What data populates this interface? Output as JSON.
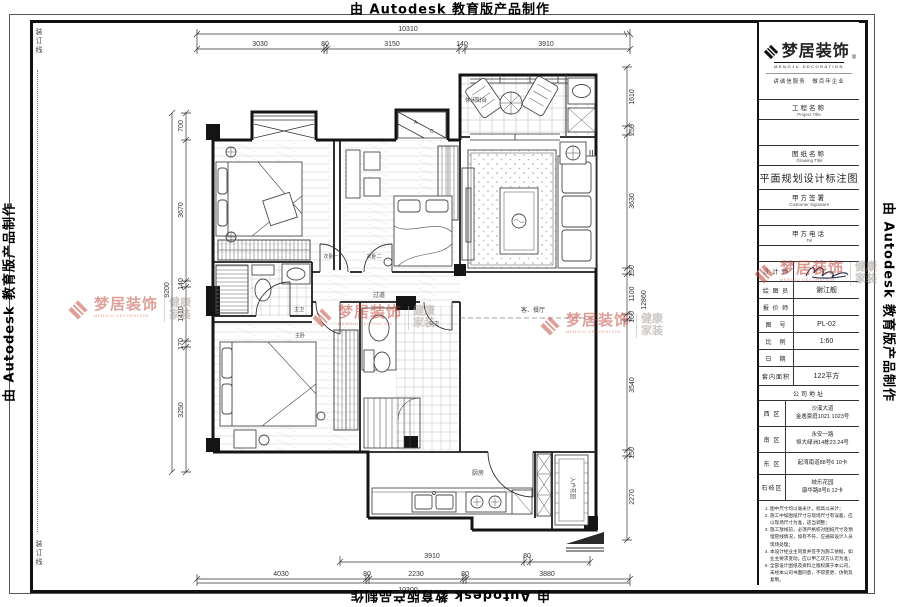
{
  "edge": {
    "autodesk": "由 Autodesk 教育版产品制作",
    "binding": "装订线"
  },
  "brand": {
    "cn": "梦居装饰",
    "reg": "®",
    "en": "MENGJU DECORATION",
    "dots": "· · · · ·   · · · · ·",
    "side1": "健康",
    "side2": "家装",
    "slogan": "讲诚信服务　做百年企业",
    "red": "#bf4136",
    "gray": "#9b948d"
  },
  "titleblock": {
    "project_cn": "工程名称",
    "project_en": "Project Title",
    "drawing_cn": "图纸名称",
    "drawing_en": "Drawing Title",
    "drawing_title": "平面规划设计标注图",
    "customer_cn": "甲方签署",
    "customer_en": "Customer Signature",
    "tel_cn": "甲方电话",
    "tel_en": "Tel",
    "designer_label": "设 计 师",
    "drafter_label": "绘 图 员",
    "drafter_value": "谢江舰",
    "pricer_label": "报 价 师",
    "no_label": "图　号",
    "no_value": "PL-02",
    "scale_label": "比　例",
    "scale_value": "1:60",
    "date_label": "日　期",
    "area_label": "套内面积",
    "area_value": "122平方",
    "address_header": "公司地址",
    "addr": [
      {
        "d": "西 区",
        "l1": "沙溪大道",
        "l2": "金逸豪庭1021 1023号"
      },
      {
        "d": "南 区",
        "l1": "永安一路",
        "l2": "恒大绿洲14栋23 24号"
      },
      {
        "d": "东 区",
        "l1": "起湾南道88号6 10卡",
        "l2": ""
      },
      {
        "d": "石岐区",
        "l1": "岐乐花园",
        "l2": "康华路8号6 12卡"
      }
    ],
    "notes": [
      "图中尺寸均以毫米计，标高以米计；",
      "施工中如图纸尺寸与现场尺寸有误差，应以现场尺寸为准，适当调整；",
      "施工放线前，必须严格校对图纸尺寸及预埋管线情况，如有不符，应通知设计人员现场处理；",
      "本设计经业主同意并签字为施工依据，如业主要求变动，应以甲乙双方认可为准；",
      "全部设计图纸及资料之版权属于本公司，未经本公司书面同意，不得变更、仿制及复制。"
    ]
  },
  "plan": {
    "rooms": {
      "bed1": "次卧一",
      "bed2": "次卧二",
      "balcony": "休闲阳台",
      "living": "客、餐厅",
      "corridor": "过道",
      "mbath": "主卫",
      "pbath": "公卫",
      "master": "主卧",
      "kitchen": "厨房",
      "entry": "入户花园"
    },
    "closet": {
      "a": "A",
      "c": "C"
    },
    "dims": {
      "top": {
        "total": "10310",
        "segs": [
          "3030",
          "80",
          "3150",
          "140",
          "3910"
        ]
      },
      "bottom": {
        "total": "10300",
        "segs": [
          "4030",
          "80",
          "2230",
          "80",
          "3880"
        ],
        "inner": [
          "3910",
          "80"
        ]
      },
      "left": {
        "total": "9200",
        "segs": [
          "700",
          "3670",
          "140",
          "1410",
          "170",
          "3250"
        ]
      },
      "right": {
        "total": "12860",
        "segs": [
          "1610",
          "250",
          "3630",
          "150",
          "1100",
          "160",
          "3540",
          "150",
          "2270"
        ]
      }
    }
  }
}
